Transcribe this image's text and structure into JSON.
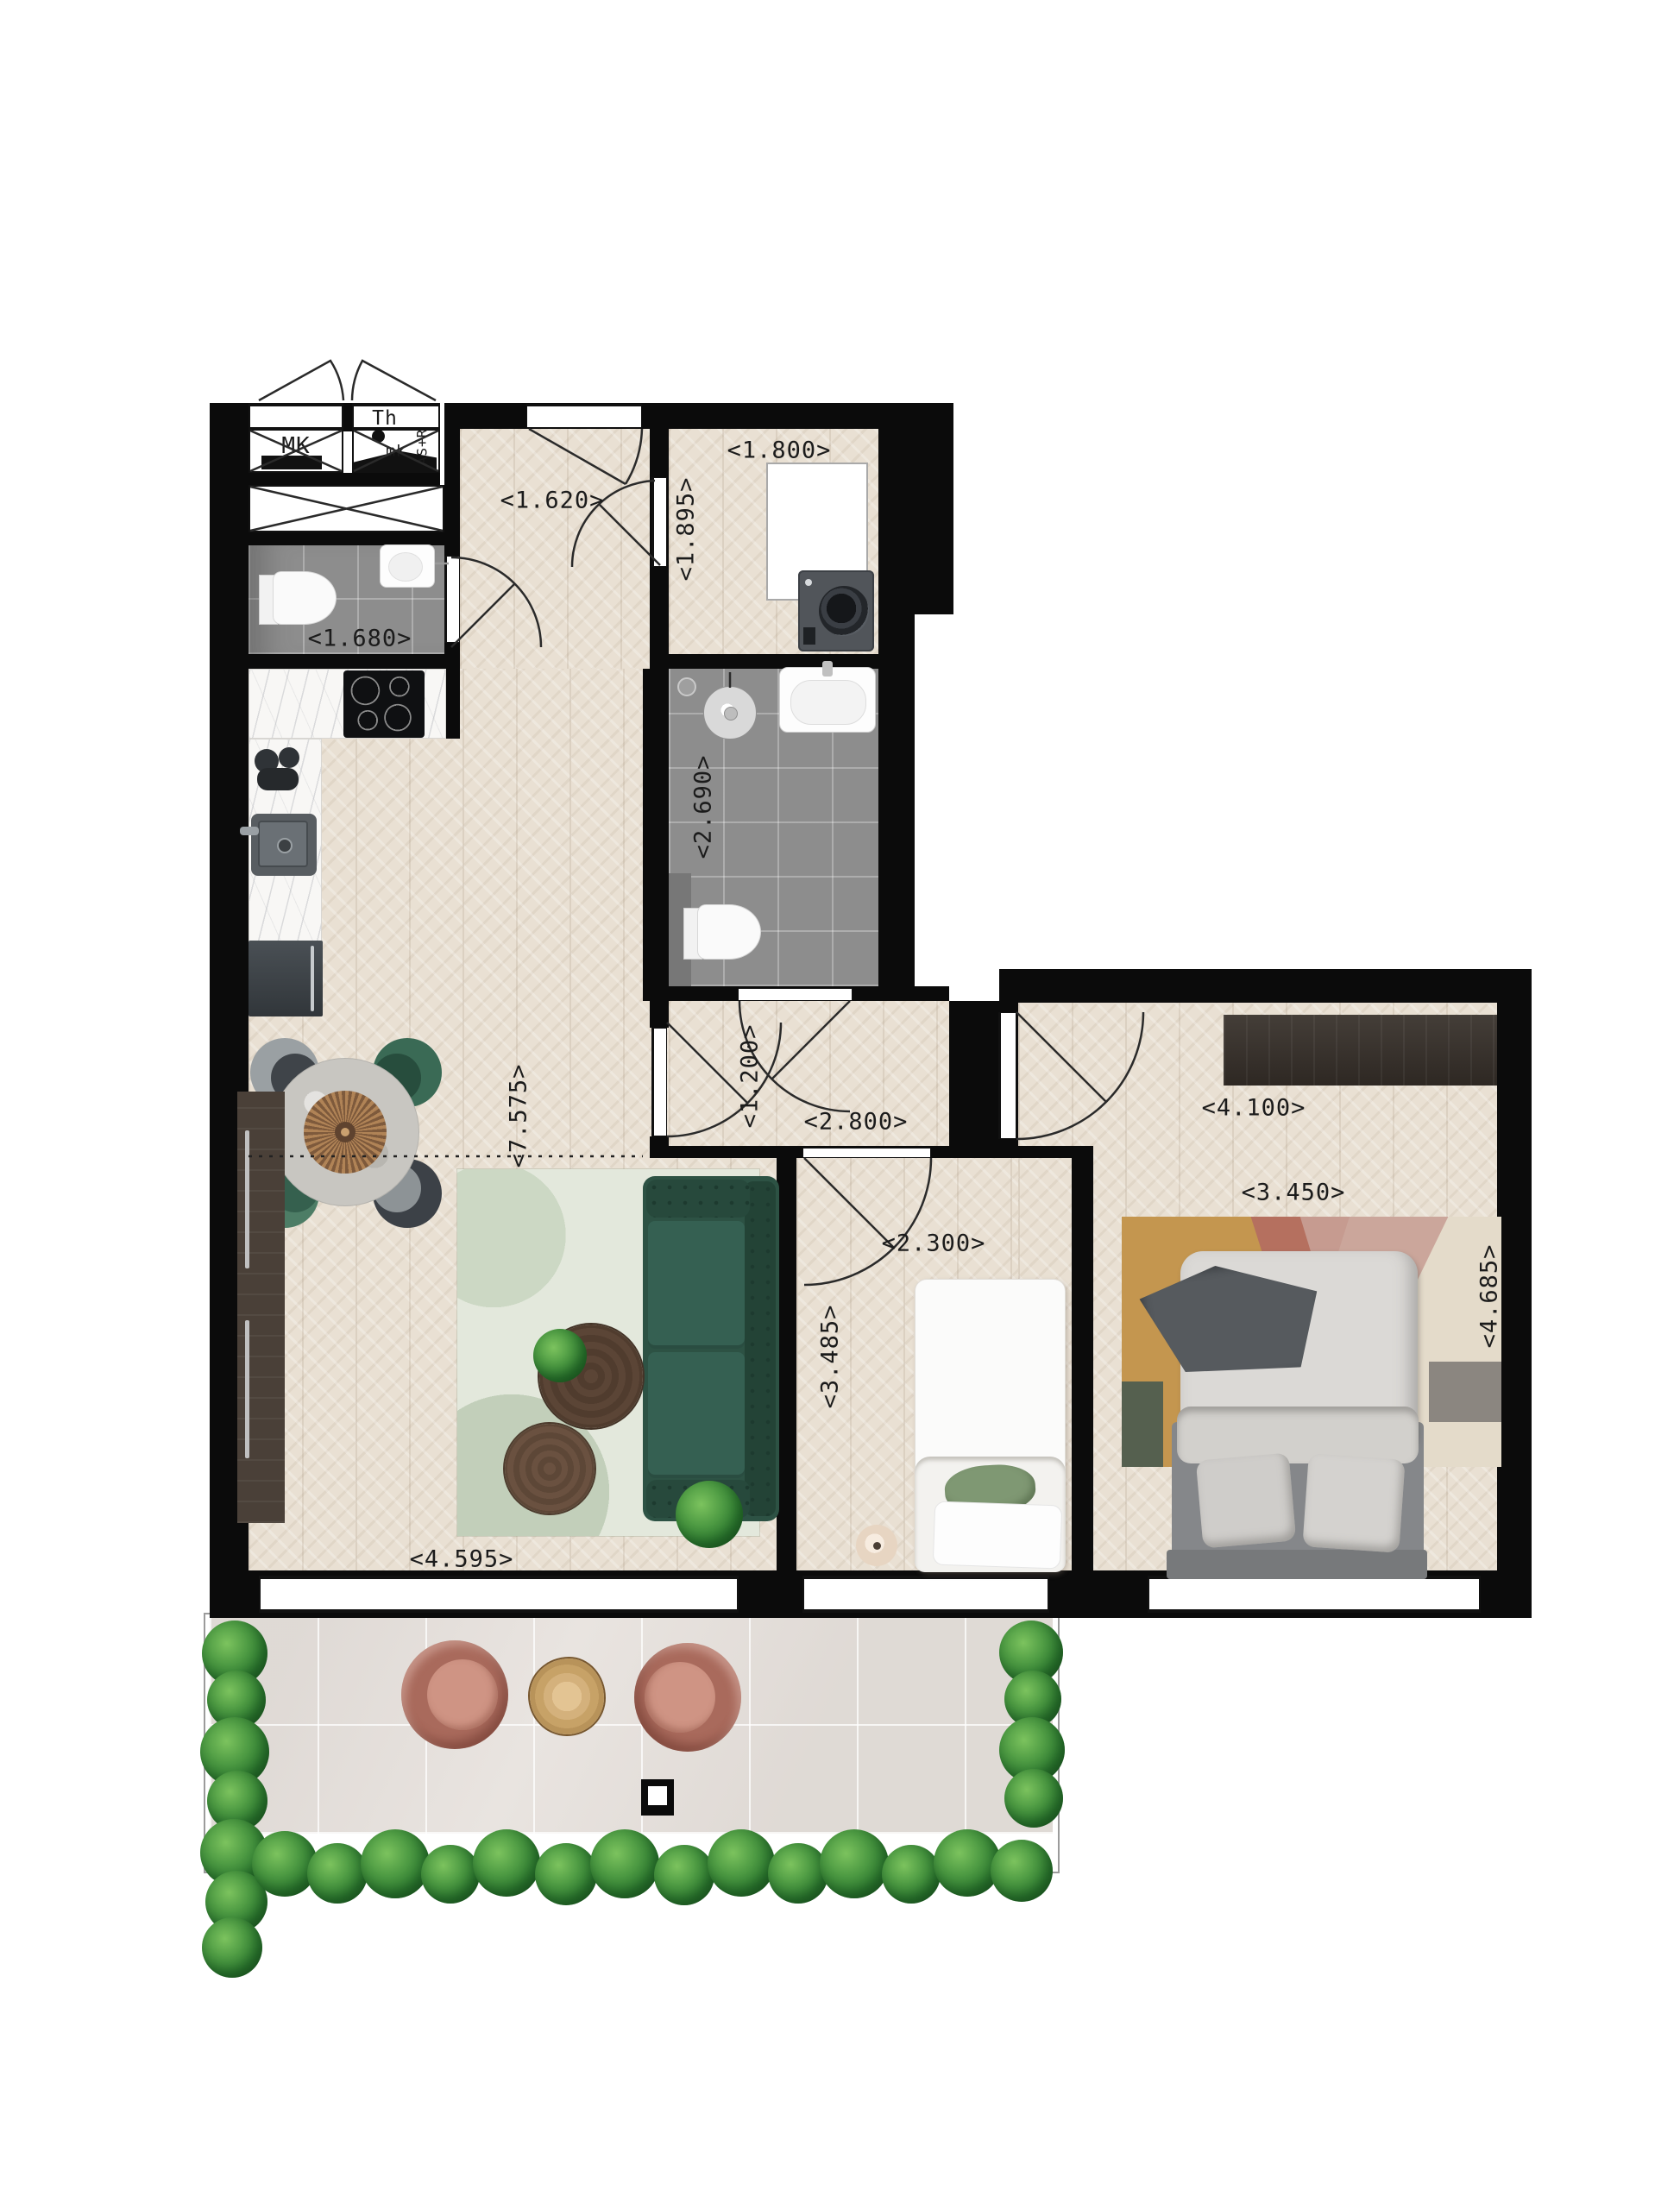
{
  "dims": {
    "entry_hall_w": "<1.620>",
    "laundry_w": "<1.800>",
    "laundry_d": "<1.895>",
    "toilet_w": "<1.680>",
    "bathroom_d": "<2.690>",
    "living_l": "<7.575>",
    "living_w": "<4.595>",
    "hall_d": "<1.200>",
    "hall_w": "<2.800>",
    "bed1_w": "<2.300>",
    "bed1_d": "<3.485>",
    "bed2_l": "<4.100>",
    "bed2_w": "<3.450>",
    "bed2_d": "<4.685>"
  },
  "tech": {
    "meter_cupboard": "MK",
    "thermostat": "Th",
    "mk_small": "mk",
    "shaft": "AS+R"
  },
  "colors": {
    "wall": "#0b0b0b",
    "wood_floor": "#e9e0d3",
    "tile_gray": "#8d8d8d",
    "balcony_stone": "#e9e4e0",
    "sofa_green": "#2d5244",
    "dining_chair_green": "#3a6a55",
    "balcony_chair_terracotta": "#ab6e60",
    "plant_green": "#2f7d33",
    "rug_sage": "#e3e8dc",
    "rug_mustard": "#c4964f",
    "wardrobe_brown": "#362f29"
  }
}
